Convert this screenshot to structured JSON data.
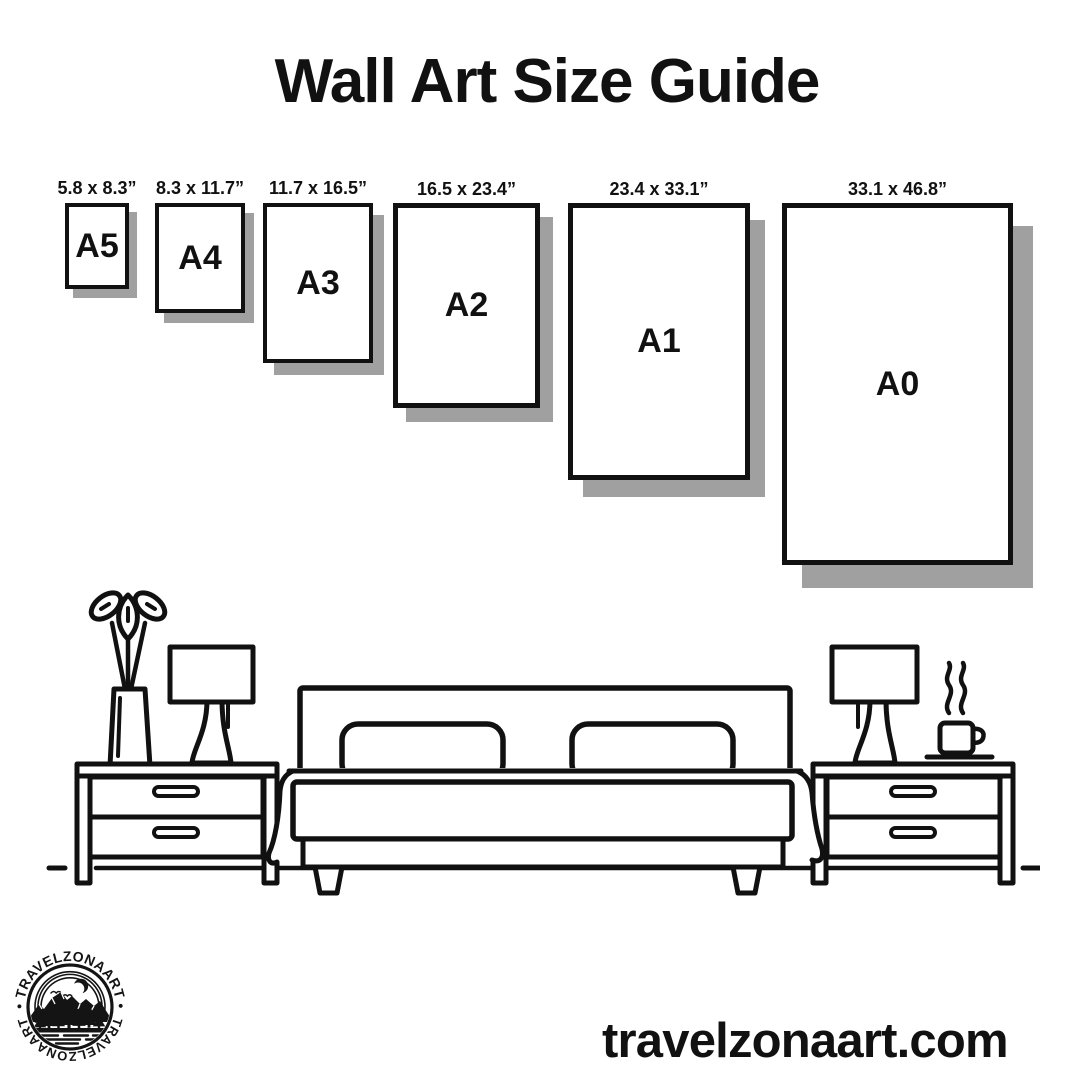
{
  "title": "Wall Art Size Guide",
  "sizes": [
    {
      "label": "A5",
      "dimensions": "5.8 x 8.3”"
    },
    {
      "label": "A4",
      "dimensions": "8.3 x 11.7”"
    },
    {
      "label": "A3",
      "dimensions": "11.7 x 16.5”"
    },
    {
      "label": "A2",
      "dimensions": "16.5 x 23.4”"
    },
    {
      "label": "A1",
      "dimensions": "23.4 x 33.1”"
    },
    {
      "label": "A0",
      "dimensions": "33.1 x 46.8”"
    }
  ],
  "illustration_items": [
    "double-bed",
    "pillows",
    "nightstand-left",
    "nightstand-right",
    "table-lamp-left",
    "table-lamp-right",
    "vase-with-plant",
    "coffee-cup-with-steam",
    "floor-line"
  ],
  "footer": {
    "website": "travelzonaart.com",
    "logo": {
      "arc_text_top": "• TRAVELZONAART •",
      "arc_text_bottom": "TRAVELZONAART"
    }
  },
  "colors": {
    "ink": "#111111",
    "shadow": "#a0a0a0",
    "background": "#ffffff"
  }
}
